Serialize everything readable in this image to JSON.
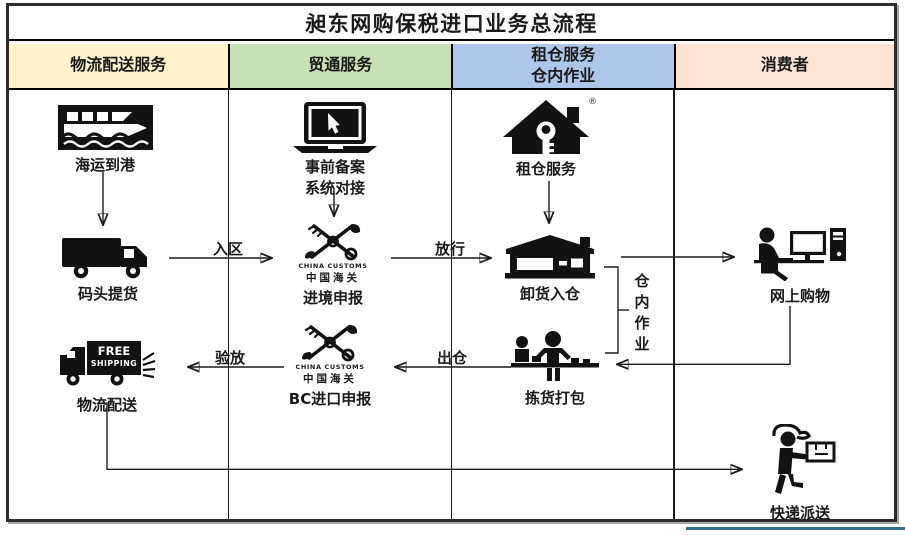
{
  "title": "昶东网购保税进口业务总流程",
  "columns": [
    {
      "label": "物流配送服务",
      "color": "#FCF2CC"
    },
    {
      "label": "贸通服务",
      "color": "#C9E0B4"
    },
    {
      "label": "租仓服务",
      "label2": "仓内作业",
      "color": "#AEC6E8"
    },
    {
      "label": "消费者",
      "color": "#FBE3D6"
    }
  ],
  "nodes": {
    "sea_arrival": {
      "label": "海运到港",
      "icon": "ship-icon"
    },
    "dock_pickup": {
      "label": "码头提货",
      "icon": "truck-icon"
    },
    "pre_filing": {
      "label1": "事前备案",
      "label2": "系统对接",
      "icon": "laptop-icon"
    },
    "entry_declaration": {
      "label": "进境申报",
      "icon": "customs-logo-icon"
    },
    "warehouse_rental": {
      "label": "租仓服务",
      "icon": "house-key-icon",
      "trademark": "®"
    },
    "unload_into_warehouse": {
      "label": "卸货入仓",
      "icon": "warehouse-icon"
    },
    "online_shopping": {
      "label": "网上购物",
      "icon": "person-computer-icon"
    },
    "picking_packing": {
      "label": "拣货打包",
      "icon": "packing-station-icon"
    },
    "bc_import_declaration": {
      "label": "BC进口申报",
      "icon": "customs-logo-icon"
    },
    "logistics_delivery": {
      "label": "物流配送",
      "icon": "free-shipping-truck-icon"
    },
    "express_delivery": {
      "label": "快递派送",
      "icon": "courier-icon"
    }
  },
  "edge_labels": {
    "enter_zone": "入区",
    "release": "放行",
    "out_of_warehouse": "出仓",
    "inspect_release": "验放"
  },
  "side_note": {
    "text": "仓内作业",
    "chars": [
      "仓",
      "内",
      "作",
      "业"
    ]
  },
  "customs_logo": {
    "en": "CHINA CUSTOMS",
    "cn": "中国海关"
  },
  "truck_text": {
    "line1": "FREE",
    "line2": "SHIPPING"
  },
  "colors": {
    "accent_underline": "#336F80",
    "border": "#2d2d2d",
    "icon": "#121212"
  }
}
